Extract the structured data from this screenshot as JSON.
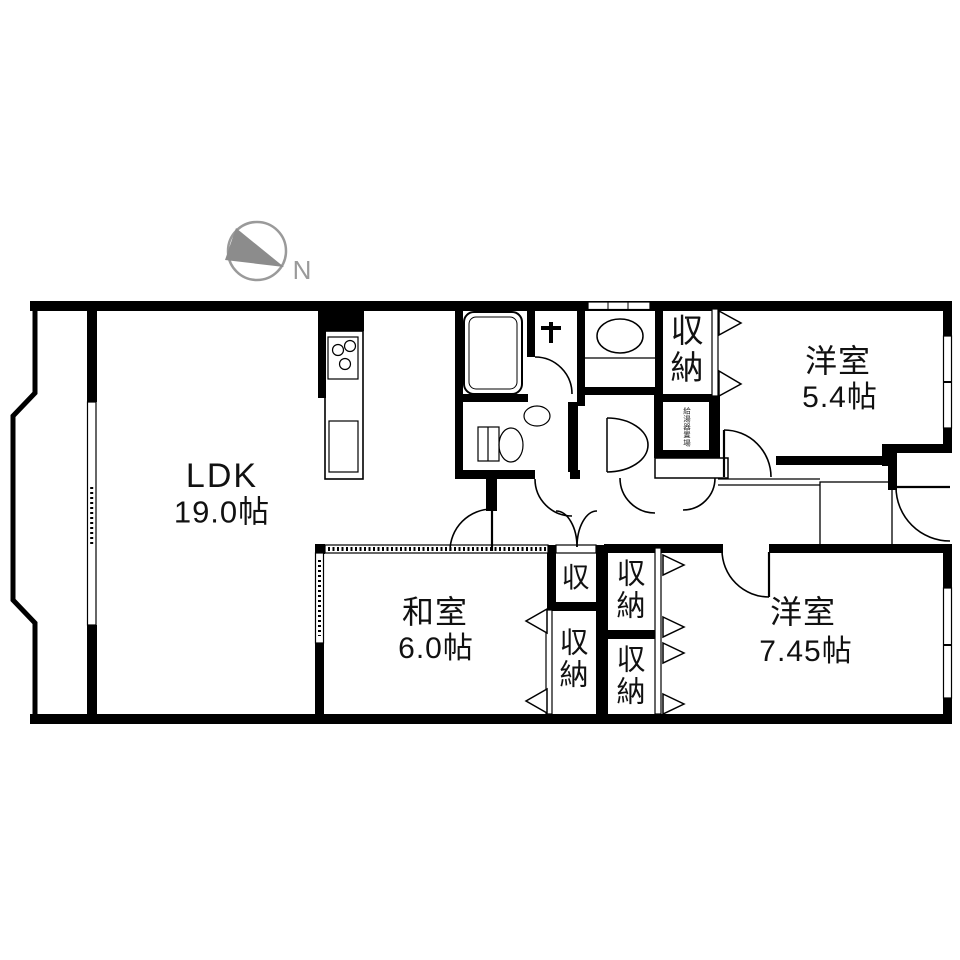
{
  "compass": {
    "label": "N"
  },
  "rooms": {
    "ldk": {
      "name": "LDK",
      "size": "19.0帖"
    },
    "washitsu": {
      "name": "和室",
      "size": "6.0帖"
    },
    "yoshitsu_small": {
      "name": "洋室",
      "size": "5.4帖"
    },
    "yoshitsu_large": {
      "name": "洋室",
      "size": "7.45帖"
    }
  },
  "storage": {
    "closet_top_right": "収納",
    "hall_closet": "収",
    "washitsu_closet": "収納",
    "mid_closet_upper": "収納",
    "mid_closet_lower": "収納",
    "utility_box": "給湯器置場"
  },
  "colors": {
    "wall": "#000000",
    "background": "#ffffff",
    "compass_gray": "#8c8c8c"
  }
}
